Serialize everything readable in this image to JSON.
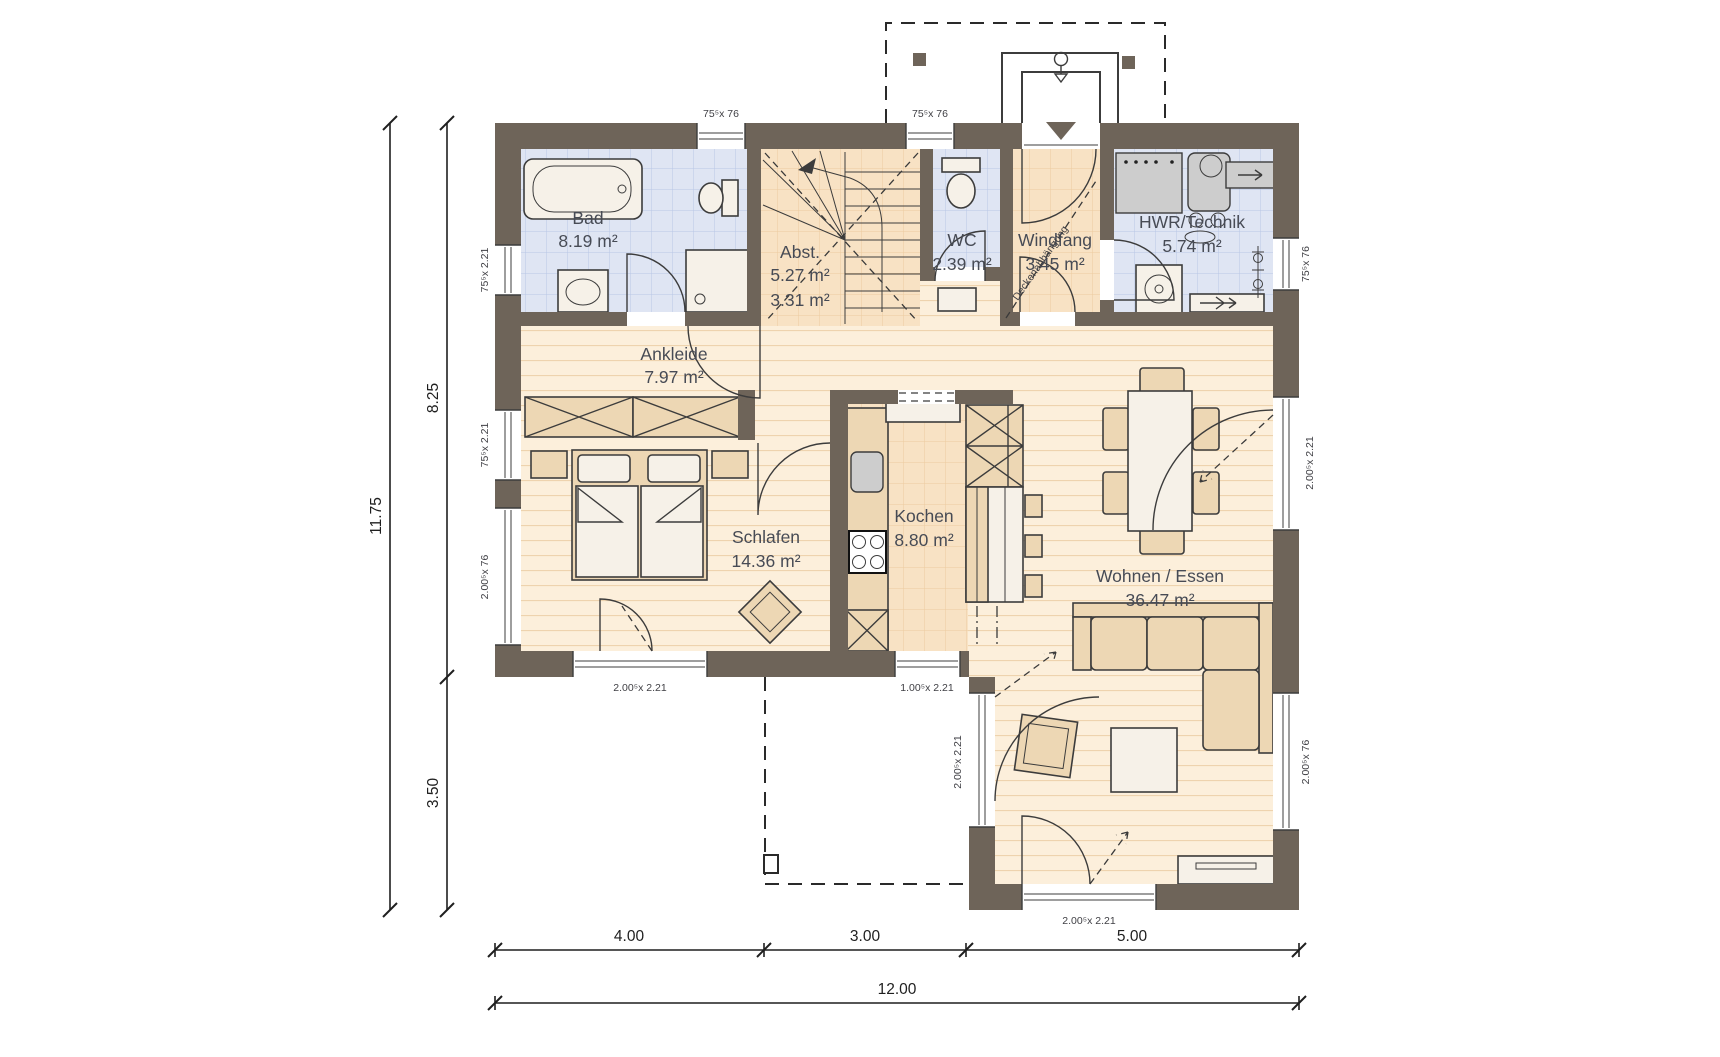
{
  "title": "Erdgeschoss Grundriss",
  "colors": {
    "wall": "#6e6459",
    "tile_blue_bg": "#dfe5f3",
    "tile_blue_line": "#b9c6e6",
    "tile_peach_bg": "#f8e2c4",
    "tile_peach_line": "#eccb9f",
    "plank_bg": "#fcefdb",
    "plank_line": "#eed3ae",
    "furniture": "#edd7b4",
    "line": "#3c3c3c",
    "text": "#474b55",
    "dim": "#1f1f1f"
  },
  "rooms": {
    "bad": {
      "name": "Bad",
      "area": "8.19 m²"
    },
    "abst": {
      "name": "Abst.",
      "area1": "5.27 m²",
      "area2": "3.31 m²"
    },
    "wc": {
      "name": "WC",
      "area": "2.39 m²"
    },
    "windfang": {
      "name": "Windfang",
      "area": "3.45 m²"
    },
    "hwr": {
      "name": "HWR/Technik",
      "area": "5.74 m²"
    },
    "ankleide": {
      "name": "Ankleide",
      "area": "7.97 m²"
    },
    "schlafen": {
      "name": "Schlafen",
      "area": "14.36 m²"
    },
    "kochen": {
      "name": "Kochen",
      "area": "8.80 m²"
    },
    "wohnen": {
      "name": "Wohnen / Essen",
      "area": "36.47 m²"
    }
  },
  "notes": {
    "ceiling": "Deckenabhängung"
  },
  "openings": {
    "top_bad": "75⁵x 76",
    "top_wc": "75⁵x 76",
    "right_hwr": "75⁵x 76",
    "right_livingdoor": "2.00⁵x 2.21",
    "right_low": "2.00⁵x 76",
    "left_bad": "75⁵x 2.21",
    "left_ankleide": "75⁵x 2.21",
    "left_schlafen": "2.00⁵x 76",
    "bottom_schlafen": "2.00⁵x 2.21",
    "bottom_kochen": "1.00⁵x 2.21",
    "bottom_living": "2.00⁵x 2.21",
    "lowerleft_door": "2.00⁵x 2.21"
  },
  "dimensions": {
    "total_height": "11.75",
    "upper_height": "8.25",
    "lower_height": "3.50",
    "bottom_1": "4.00",
    "bottom_2": "3.00",
    "bottom_3": "5.00",
    "total_width": "12.00"
  }
}
